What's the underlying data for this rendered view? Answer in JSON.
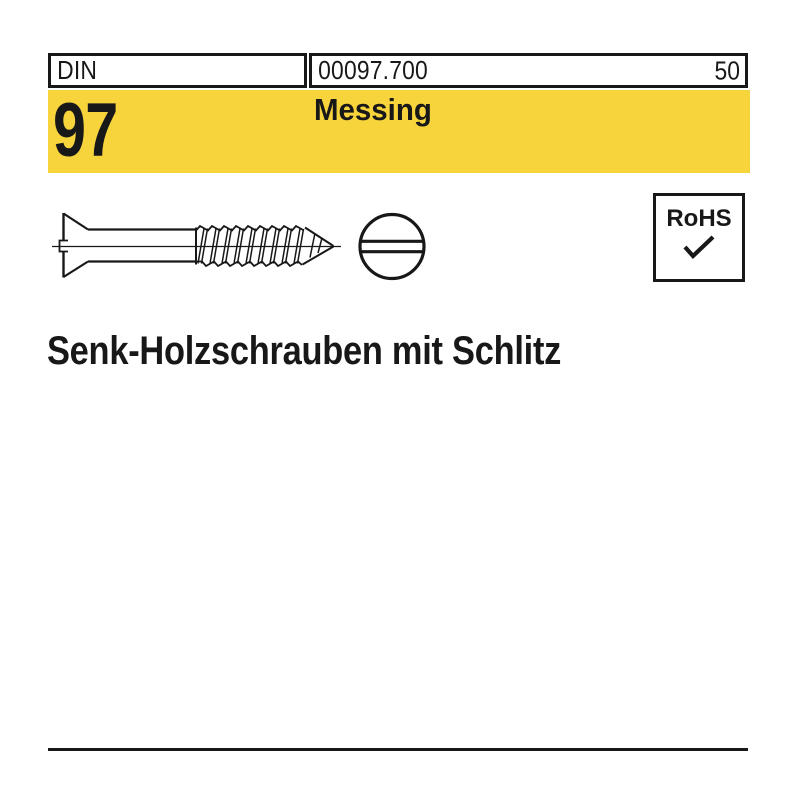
{
  "page": {
    "background_color": "#ffffff",
    "ink_color": "#181818"
  },
  "header": {
    "standard_label": "DIN",
    "article_number": "00097.700",
    "page_number": "50"
  },
  "banner": {
    "standard_number": "97",
    "material": "Messing",
    "background_color": "#F7D33C"
  },
  "drawing": {
    "side_view_alt": "countersunk-slotted-wood-screw-side-view",
    "front_view_alt": "screw-head-front-view-with-slot"
  },
  "rohs_badge": {
    "label": "RoHS",
    "check_icon": "✓"
  },
  "title": "Senk-Holzschrauben mit Schlitz"
}
